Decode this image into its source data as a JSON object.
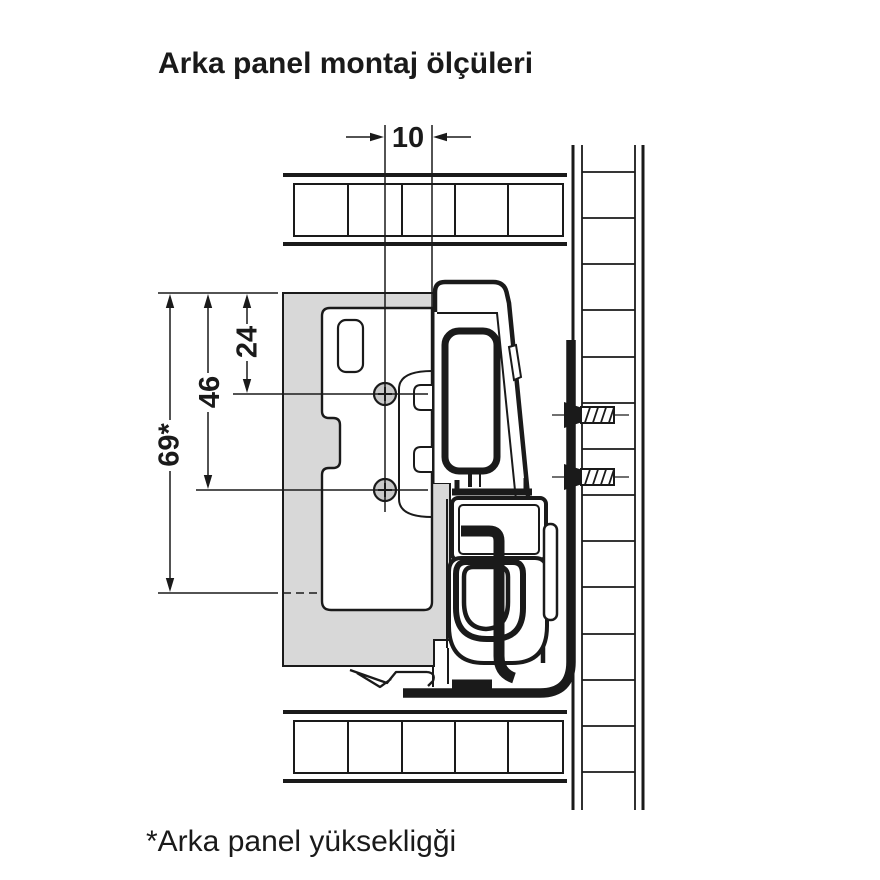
{
  "title": "Arka panel montaj ölçüleri",
  "footnote": "*Arka panel yüksekligği",
  "dims": {
    "slide_offset": "10",
    "hole1_from_top": "24",
    "hole2_from_top": "46",
    "panel_height": "69*"
  },
  "colors": {
    "line": "#1a1a1a",
    "panel_gray": "#d8d8d8",
    "hole_gray": "#c9c9c9",
    "background": "#ffffff"
  }
}
